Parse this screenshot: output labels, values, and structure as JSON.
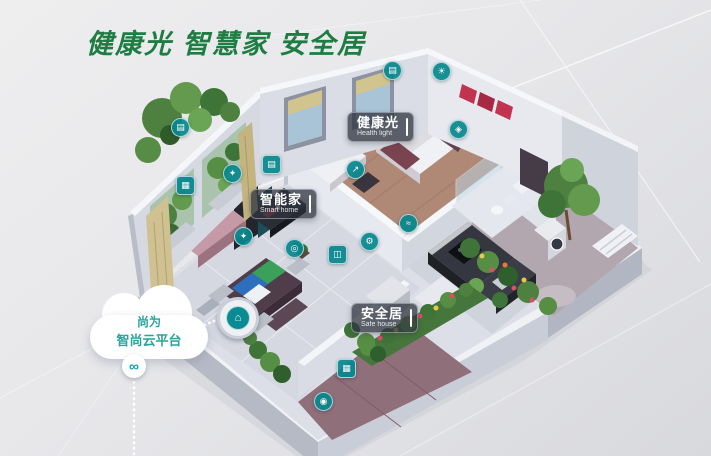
{
  "page": {
    "title_zh": "健康光 智慧家 安全居"
  },
  "cloud": {
    "line1": "尚为",
    "line2": "智尚云平台"
  },
  "tags": {
    "health": {
      "zh": "健康光",
      "en": "Health light"
    },
    "smart": {
      "zh": "智能家",
      "en": "Smart home"
    },
    "safe": {
      "zh": "安全居",
      "en": "Safe house"
    }
  },
  "icons": {
    "curtain": "▤",
    "panel": "▦",
    "bulb": "✦",
    "scene": "◎",
    "door": "◫",
    "gear": "⚙",
    "wave": "≈",
    "arrow": "↗",
    "sensor": "◈",
    "doorbell": "◉",
    "light": "☀",
    "hub": "⌂",
    "link": "∞"
  },
  "colors": {
    "title_green": "#1e7d43",
    "icon_teal": "#0a8b93",
    "cloud_text_teal": "#2aa39a",
    "tag_background": "rgba(44,50,62,0.74)",
    "accent_red_art": "#c23350"
  }
}
